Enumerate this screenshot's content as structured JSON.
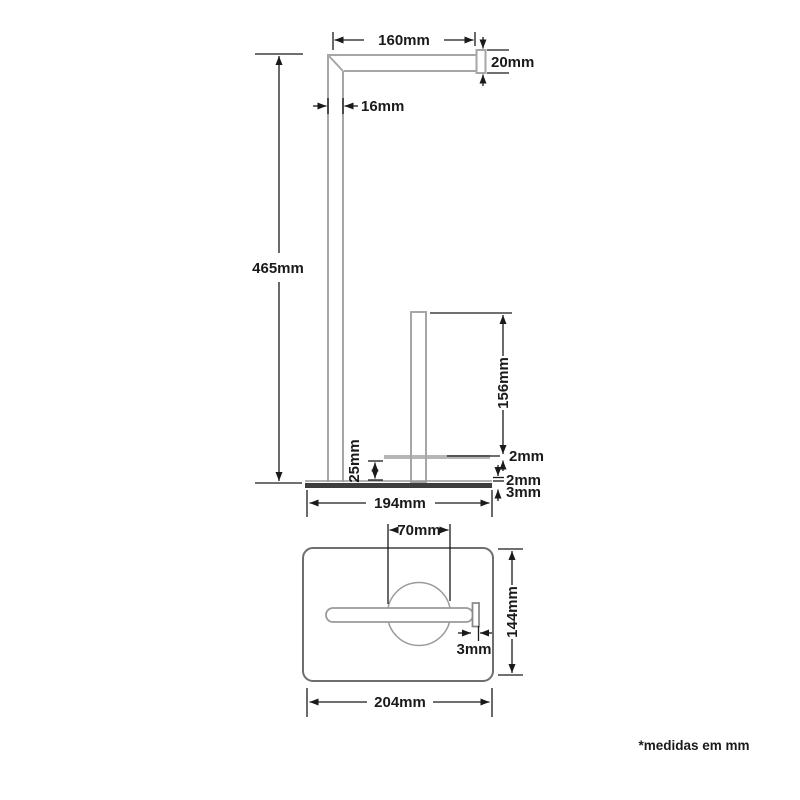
{
  "footnote": "*medidas em mm",
  "front_view": {
    "arm_length": "160mm",
    "arm_height": "20mm",
    "post_width": "16mm",
    "total_height": "465mm",
    "spare_post_height": "156mm",
    "rest_plate_thickness": "2mm",
    "rest_height": "25mm",
    "base_top_thickness": "2mm",
    "base_plate_thickness": "3mm",
    "base_width": "194mm"
  },
  "top_view": {
    "roll_diameter": "70mm",
    "base_depth": "144mm",
    "arm_end_thickness": "3mm",
    "base_length": "204mm"
  },
  "colors": {
    "object_line": "#a6a6a6",
    "dimension_line": "#1a1a1a",
    "base_fill": "#3d3d3d",
    "rest_bar_fill": "#b6b6b6",
    "background": "#ffffff"
  }
}
